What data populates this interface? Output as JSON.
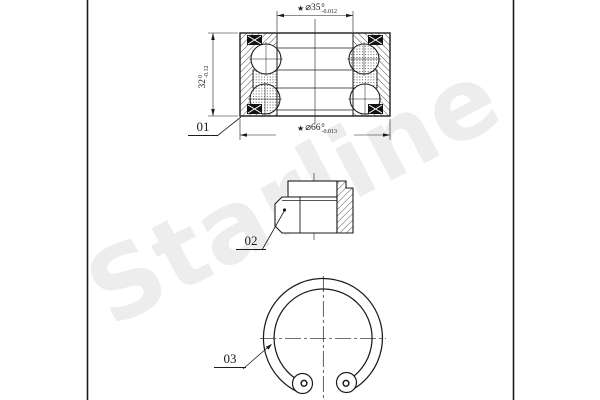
{
  "watermark": {
    "text": "Starline"
  },
  "parts": [
    {
      "label": "01"
    },
    {
      "label": "02"
    },
    {
      "label": "03"
    }
  ],
  "dims": {
    "bore": {
      "star": "★",
      "value": "⌀35",
      "tol_top": "0",
      "tol_bottom": "-0.012"
    },
    "od": {
      "star": "★",
      "value": "⌀66",
      "tol_top": "0",
      "tol_bottom": "-0.013"
    },
    "width": {
      "value": "32",
      "tol_top": "0",
      "tol_bottom": "-0.12"
    }
  },
  "colors": {
    "line": "#1c1c1c",
    "watermark": "#ededed",
    "background": "#ffffff",
    "seal": "#111111"
  }
}
